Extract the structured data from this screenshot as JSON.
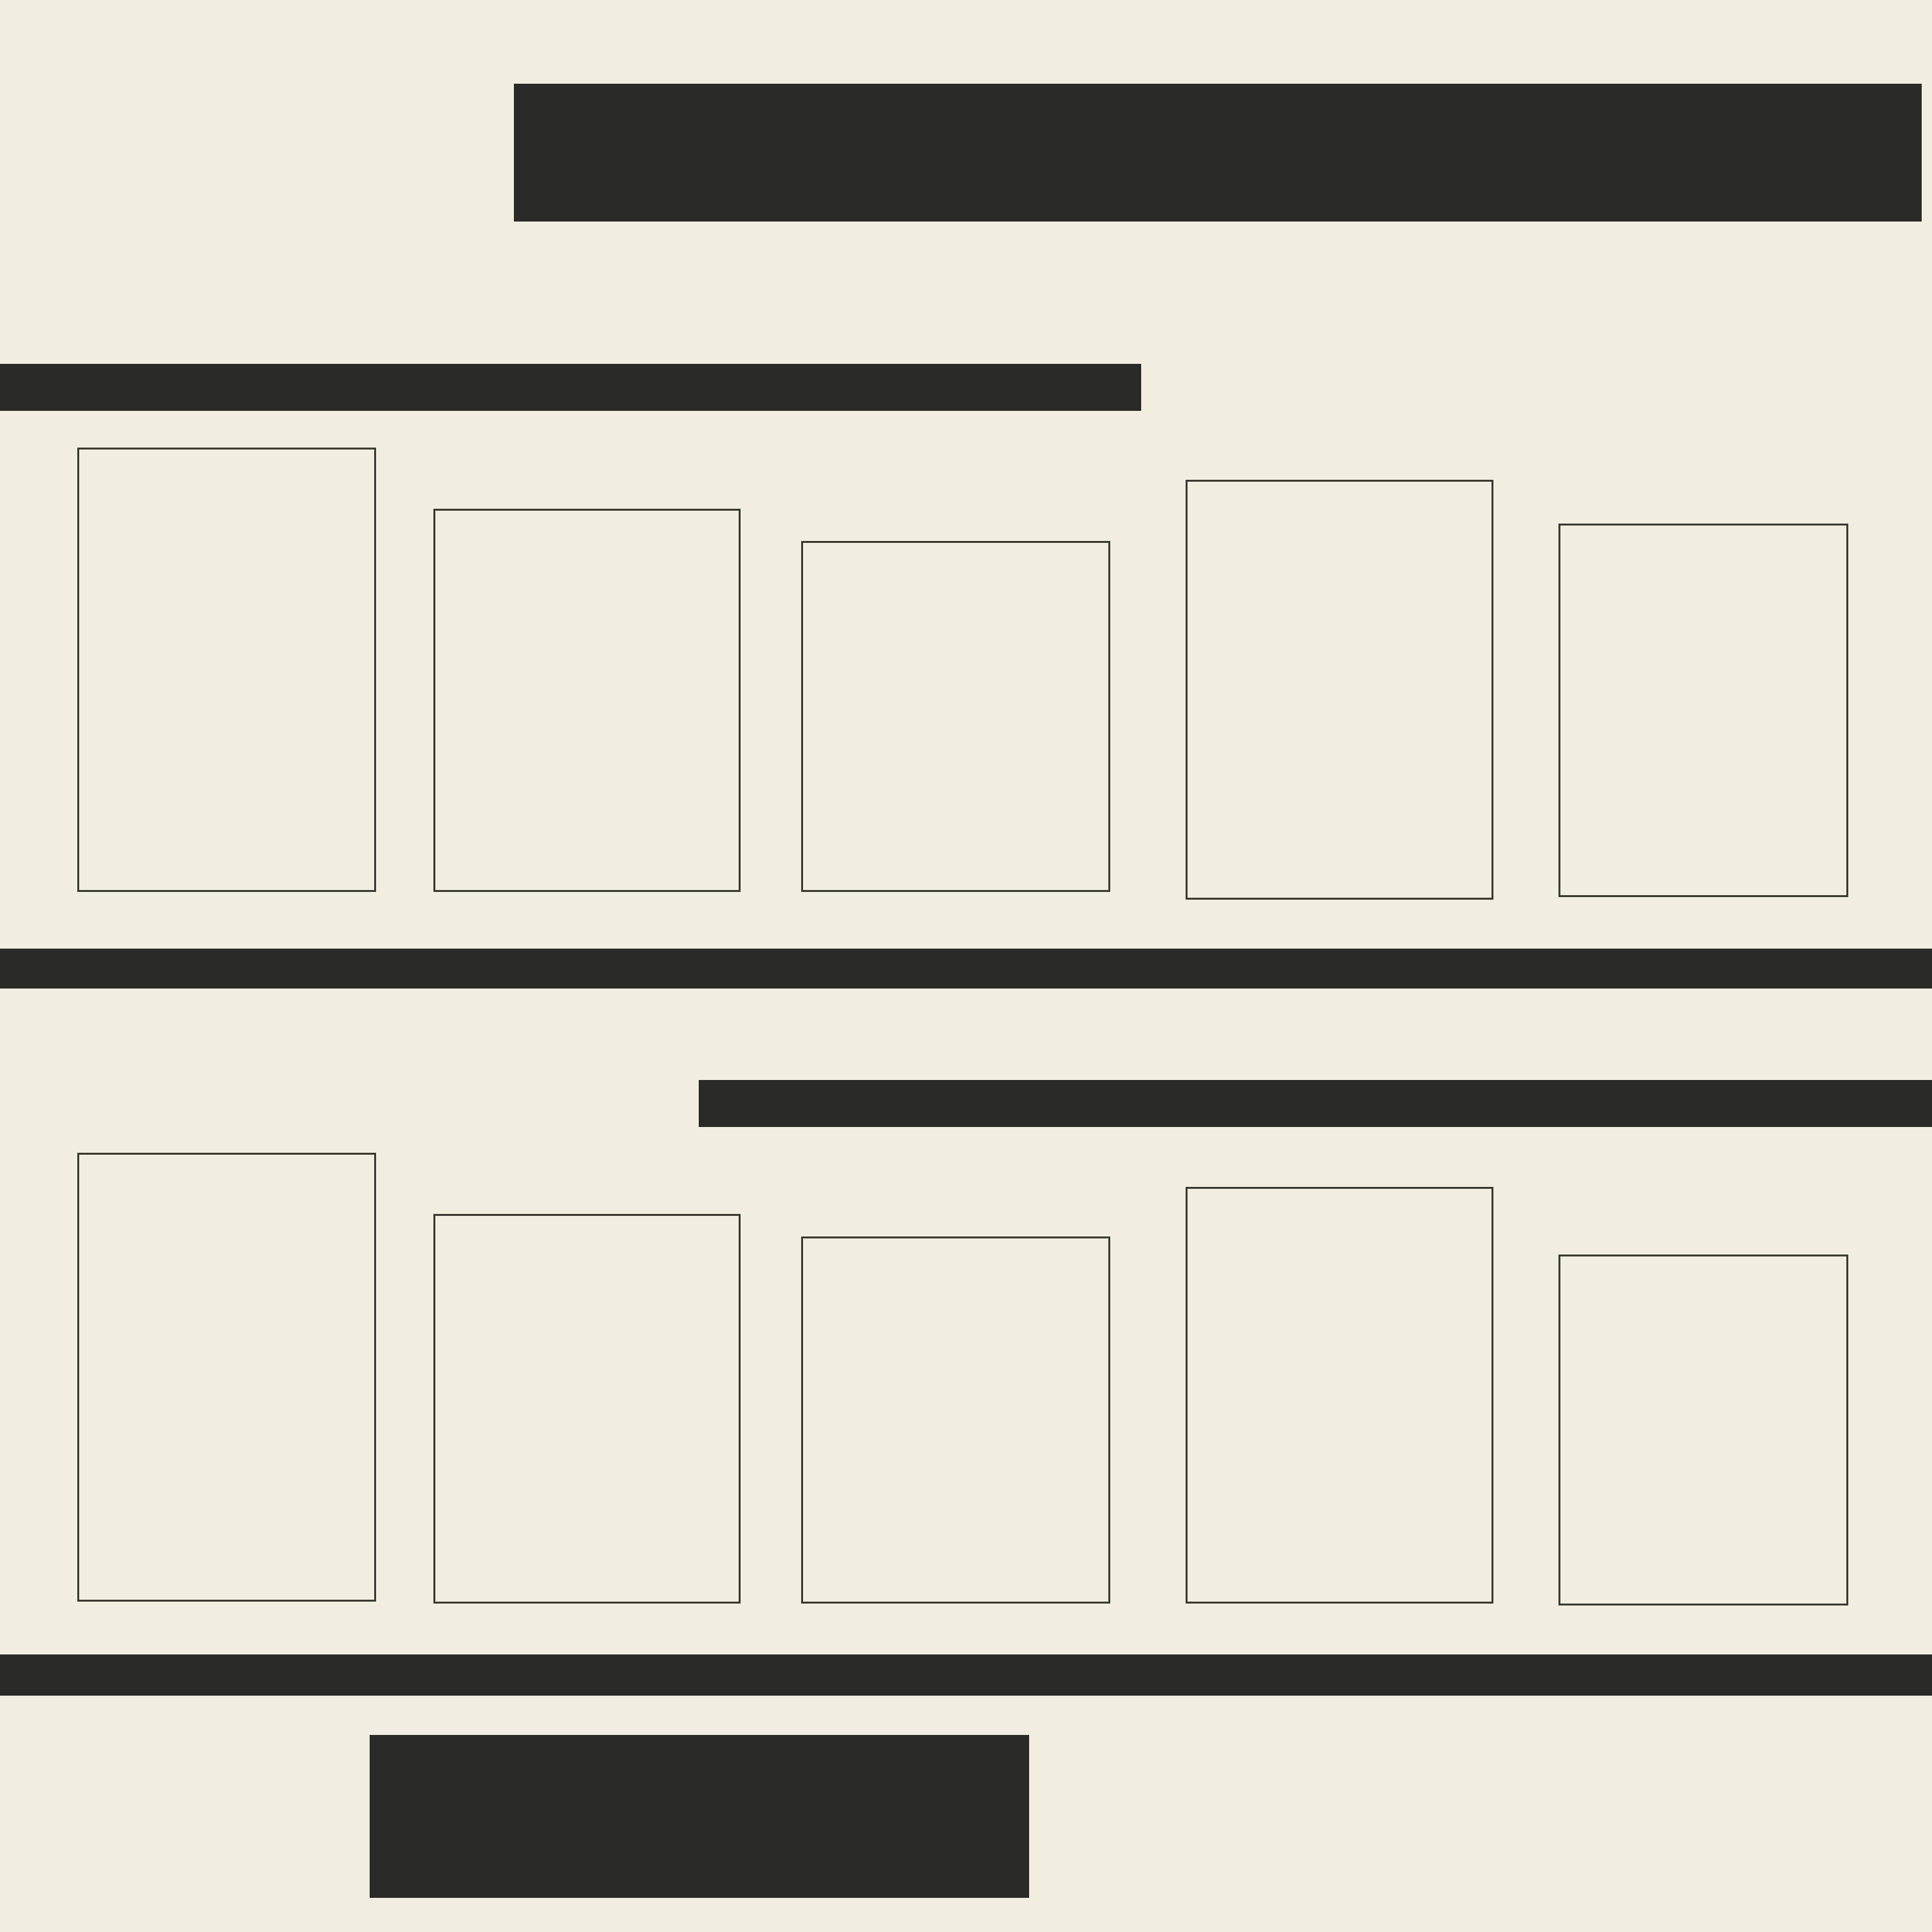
{
  "title": "SIZE INFO",
  "sections": {
    "inches": {
      "banner": "INCHES SIZES",
      "boxes": [
        {
          "name": "ratio-2-3",
          "sizes": [
            "4 x 6",
            "6 x 9",
            "8 x 12",
            "10 x 15",
            "12 x 18",
            "16 x 24",
            "20 x 30",
            "24 x 36"
          ]
        },
        {
          "name": "ratio-3-4",
          "sizes": [
            "6 x 8",
            "9 x 12",
            "12 x 16",
            "15 x 20",
            "18 x 24",
            "24 x 32"
          ]
        },
        {
          "name": "ratio-4-5",
          "sizes": [
            "4 x 5",
            "8 x 10",
            "12 x 15",
            "16 x 20",
            "24 x 30"
          ]
        },
        {
          "name": "iso",
          "sizes": [
            "5 x 7",
            "A5",
            "A4",
            "A3",
            "A2",
            "A1"
          ]
        },
        {
          "name": "11x14",
          "sizes": [
            "11 x 14",
            "22 x 28"
          ]
        }
      ],
      "footer_labels": [
        "RATIO 2:3",
        "RATIO 3:4",
        "RATIO 4:5",
        "ISO",
        "11x14 INCH"
      ]
    },
    "centimeters": {
      "banner": "CENTIMETERS SIZES",
      "boxes": [
        {
          "name": "ratio-2-3",
          "sizes": [
            "10 x 15",
            "15 x 23",
            "20 x 30",
            "25 x 38",
            "30 x 45",
            "40 x 60",
            "48 x 75",
            "60 x 90"
          ]
        },
        {
          "name": "ratio-3-4",
          "sizes": [
            "15 x 20",
            "22 x 30",
            "30 x 40",
            "38 x 50",
            "45 x 60",
            "60 x 80"
          ]
        },
        {
          "name": "ratio-4-5",
          "sizes": [
            "10 x 12",
            "20 x 25",
            "28 x 35",
            "30 x 38",
            "40 x 50",
            "60 x 75"
          ]
        },
        {
          "name": "iso",
          "sizes": [
            "13 x 18",
            "15 x 21",
            "21 x 30",
            "30 x 42",
            "42 x 59",
            "50 x 70",
            "59 x 84"
          ]
        },
        {
          "name": "11x14",
          "sizes": [
            "28 x 36",
            "56 x 72"
          ]
        }
      ],
      "footer_labels": [
        "RATIO 2:3",
        "RATIO 3:4",
        "RATIO 4:5",
        "ISO",
        "11x14 INCH"
      ]
    },
    "logo": {
      "script_left": "cust",
      "script_right": "om",
      "subtitle": "Designs"
    },
    "colors": {
      "background": "#f1eee1",
      "dark": "#2a2a28",
      "cream_text": "#efecdf",
      "white_text": "#fffdf4",
      "ink": "#242422",
      "box_border": "#3a3a31"
    }
  }
}
